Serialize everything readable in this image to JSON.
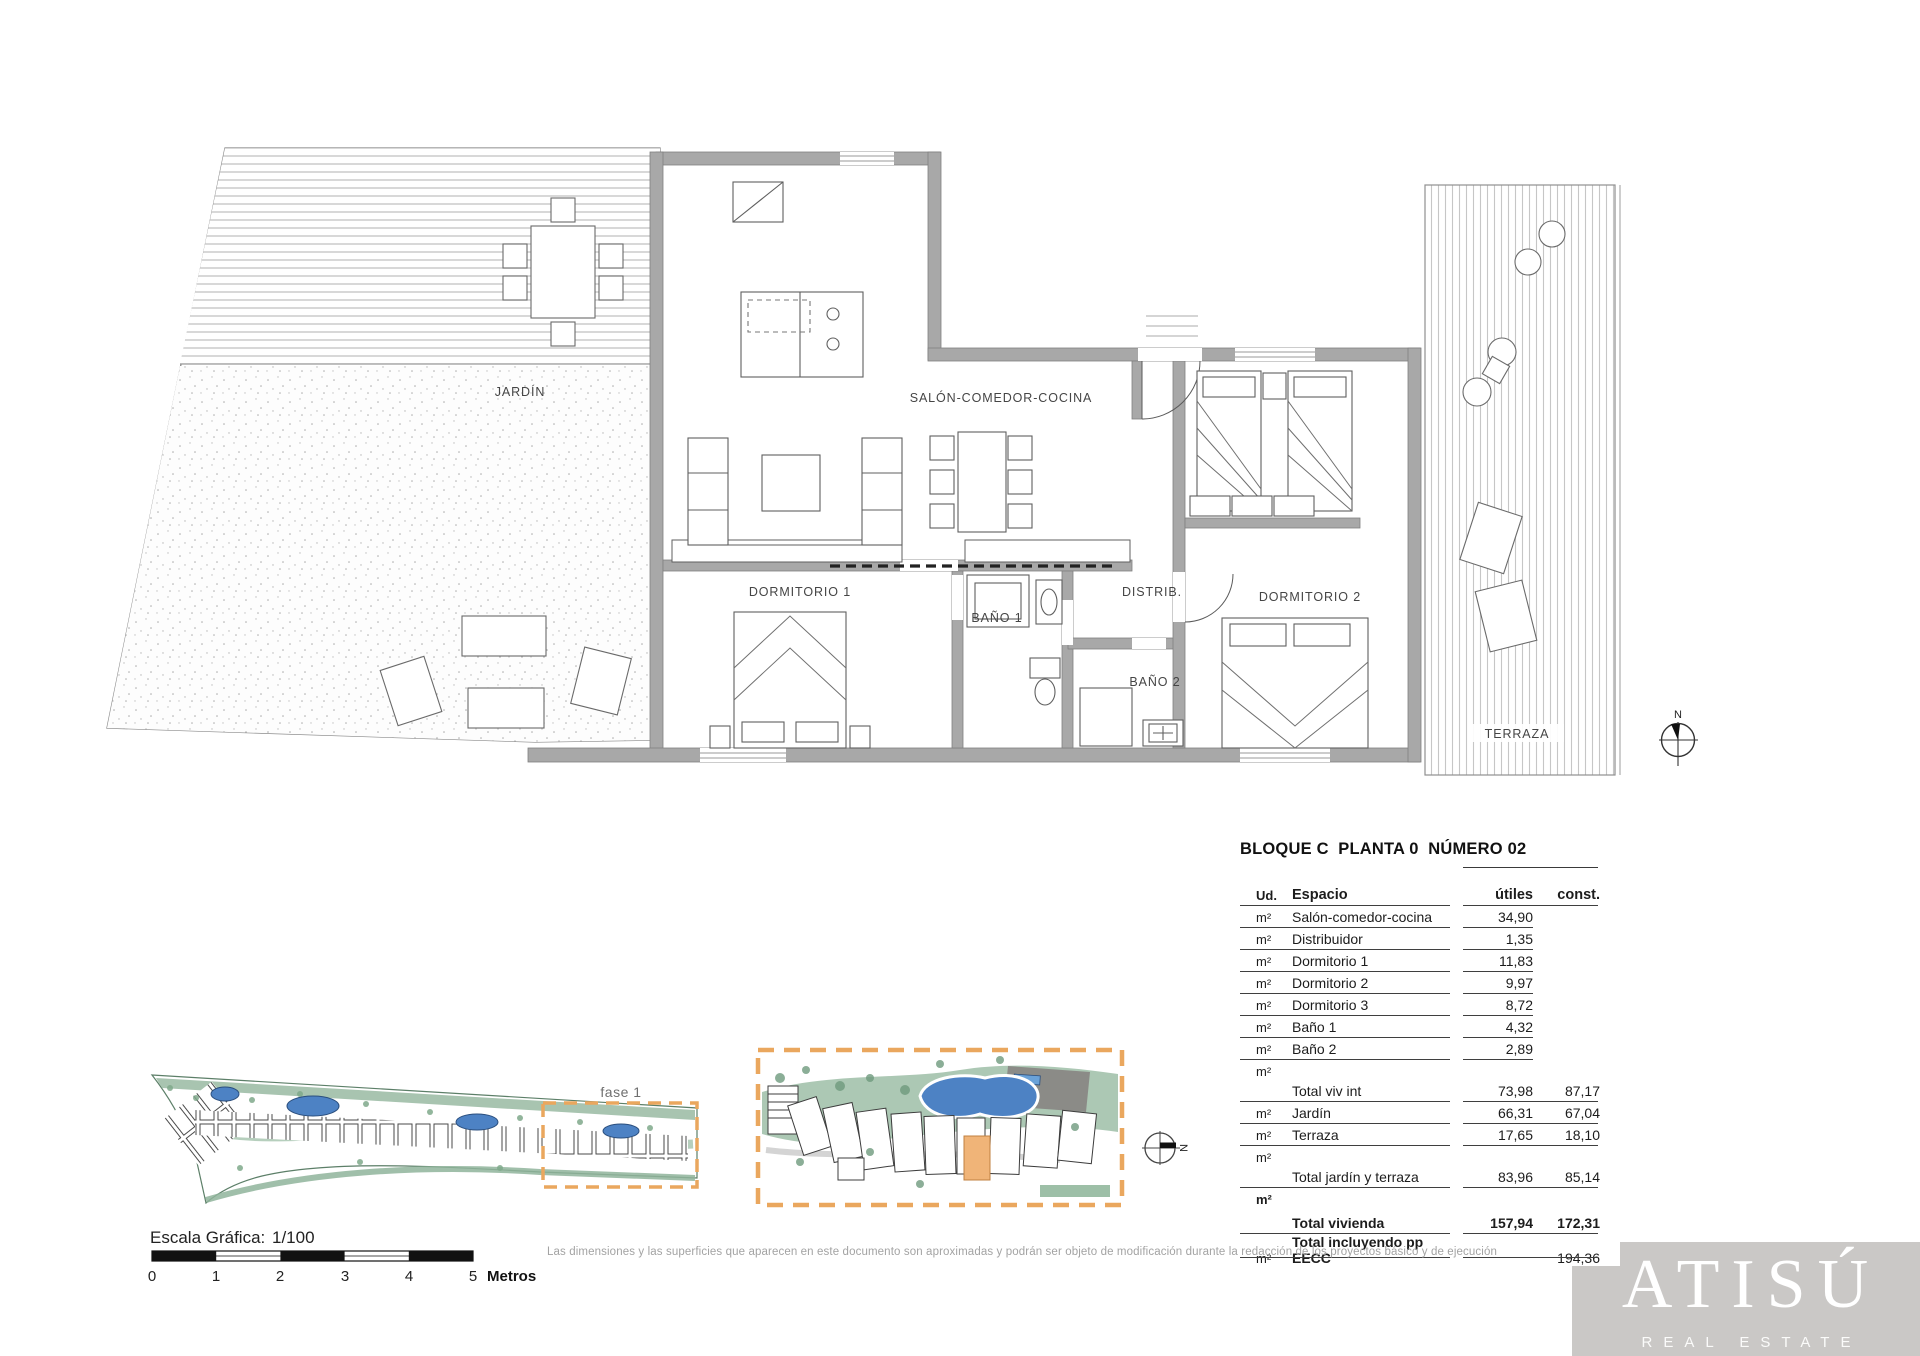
{
  "sheet": {
    "rooms": {
      "jardin": "JARDÍN",
      "salon": "SALÓN-COMEDOR-COCINA",
      "dormitorio1": "DORMITORIO 1",
      "bano1": "BAÑO 1",
      "distrib": "DISTRIB.",
      "bano2": "BAÑO 2",
      "dormitorio2": "DORMITORIO 2",
      "terraza": "TERRAZA"
    },
    "north_label": "N",
    "site_overview": {
      "phase_label": "fase 1"
    },
    "site_detail": {
      "north_label": "N"
    },
    "scale_bar": {
      "label": "Escala Gráfica:",
      "ratio": "1/100",
      "ticks": [
        "0",
        "1",
        "2",
        "3",
        "4",
        "5"
      ],
      "units_label": "Metros"
    },
    "summary_table": {
      "title": "BLOQUE C  PLANTA 0  NÚMERO 02",
      "columns": {
        "unit": "Ud.",
        "space": "Espacio",
        "useful": "útiles",
        "built": "const."
      },
      "rows": [
        {
          "ud": "m²",
          "espacio": "Salón-comedor-cocina",
          "utiles": "34,90",
          "const": ""
        },
        {
          "ud": "m²",
          "espacio": "Distribuidor",
          "utiles": "1,35",
          "const": ""
        },
        {
          "ud": "m²",
          "espacio": "Dormitorio 1",
          "utiles": "11,83",
          "const": ""
        },
        {
          "ud": "m²",
          "espacio": "Dormitorio 2",
          "utiles": "9,97",
          "const": ""
        },
        {
          "ud": "m²",
          "espacio": "Dormitorio 3",
          "utiles": "8,72",
          "const": ""
        },
        {
          "ud": "m²",
          "espacio": "Baño 1",
          "utiles": "4,32",
          "const": ""
        },
        {
          "ud": "m²",
          "espacio": "Baño 2",
          "utiles": "2,89",
          "const": ""
        },
        {
          "ud": "m²",
          "espacio": "Total viv int",
          "utiles": "73,98",
          "const": "87,17",
          "type": "total"
        },
        {
          "ud": "m²",
          "espacio": "Jardín",
          "utiles": "66,31",
          "const": "67,04"
        },
        {
          "ud": "m²",
          "espacio": "Terraza",
          "utiles": "17,65",
          "const": "18,10"
        },
        {
          "ud": "m²",
          "espacio": "Total jardín y terraza",
          "utiles": "83,96",
          "const": "85,14",
          "type": "total"
        },
        {
          "ud": "m²",
          "espacio": "Total vivienda",
          "utiles": "157,94",
          "const": "172,31",
          "type": "total-bold"
        },
        {
          "ud": "m²",
          "espacio": "Total incluyendo pp EECC",
          "utiles": "",
          "const": "194,36",
          "type": "last"
        }
      ]
    },
    "disclaimer": "Las dimensiones y las superficies que aparecen en este documento son aproximadas y podrán ser objeto de modificación durante la redacción de los proyectos básico y de ejecución",
    "brand": {
      "name": "ATISÚ",
      "tagline": "REAL ESTATE"
    },
    "colors": {
      "accent_orange": "#eaa75e",
      "highlight_unit": "#f0b478",
      "pool_blue": "#4d82c4",
      "landscape_green": "#a3c2ac",
      "wall_gray": "#a8a8a8",
      "logo_gray": "#cac8c6"
    }
  }
}
